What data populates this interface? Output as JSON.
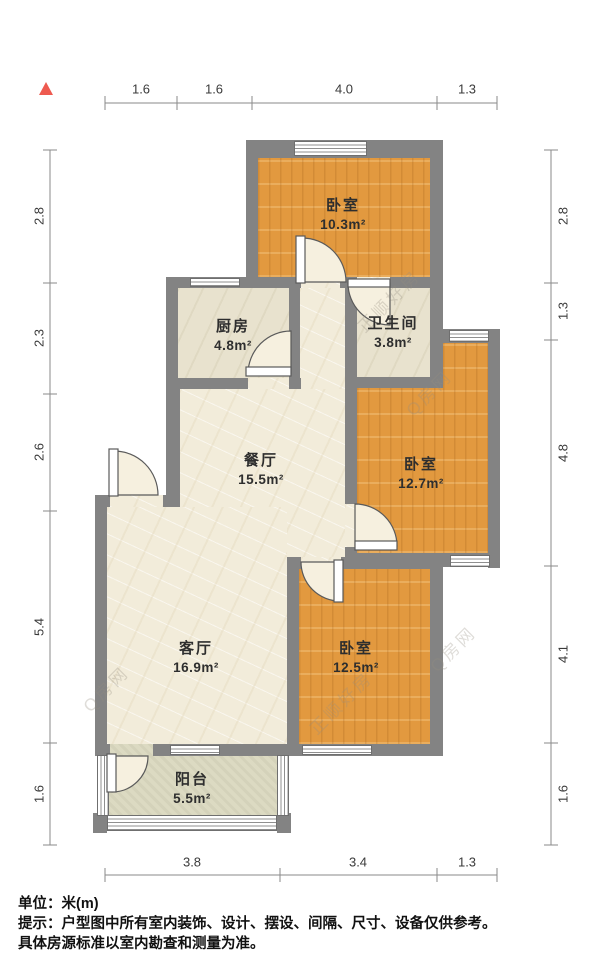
{
  "dimensions": {
    "top": [
      "1.6",
      "1.6",
      "4.0",
      "1.3"
    ],
    "bottom": [
      "3.8",
      "3.4",
      "1.3"
    ],
    "left": [
      "2.8",
      "2.3",
      "2.6",
      "5.4",
      "1.6"
    ],
    "right": [
      "2.8",
      "1.3",
      "4.8",
      "4.1",
      "1.6"
    ]
  },
  "rooms": [
    {
      "id": "bedroom-top",
      "name": "卧室",
      "area": "10.3m²"
    },
    {
      "id": "kitchen",
      "name": "厨房",
      "area": "4.8m²"
    },
    {
      "id": "bathroom",
      "name": "卫生间",
      "area": "3.8m²"
    },
    {
      "id": "dining",
      "name": "餐厅",
      "area": "15.5m²"
    },
    {
      "id": "bedroom-mid",
      "name": "卧室",
      "area": "12.7m²"
    },
    {
      "id": "living",
      "name": "客厅",
      "area": "16.9m²"
    },
    {
      "id": "bedroom-bottom",
      "name": "卧室",
      "area": "12.5m²"
    },
    {
      "id": "balcony",
      "name": "阳台",
      "area": "5.5m²"
    }
  ],
  "watermarks": {
    "brand_a": "正顺好房",
    "brand_b": "Q房网"
  },
  "footer": {
    "unit_line": "单位：米(m)",
    "tip_line1": "提示：户型图中所有室内装饰、设计、摆设、间隔、尺寸、设备仅供参考。",
    "tip_line2": "具体房源标准以室内勘查和测量为准。"
  },
  "colors": {
    "wall": "#838383",
    "wood": "#e2993f",
    "cream": "#f2ecda",
    "khaki": "#e8e2ce",
    "balcony": "#dcdac2",
    "north": "#ee5a50"
  }
}
